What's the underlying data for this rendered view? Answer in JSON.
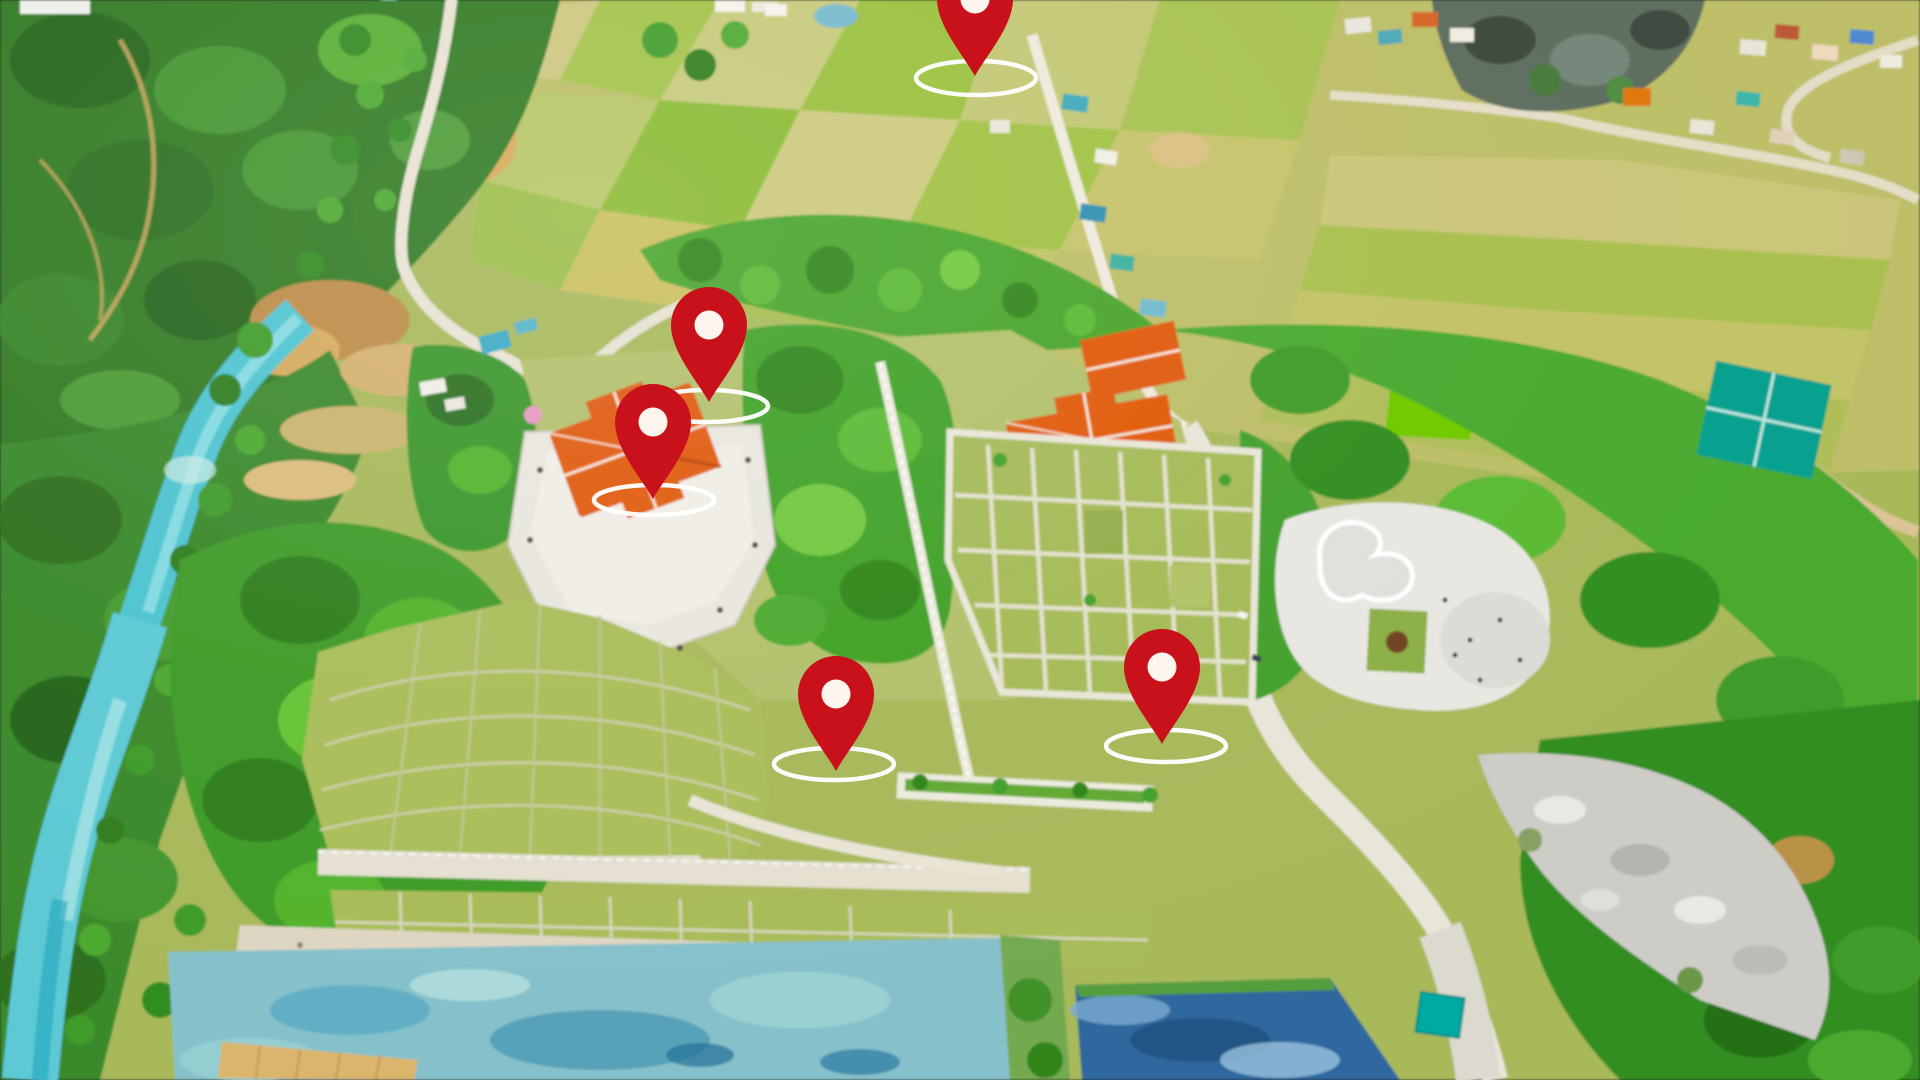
{
  "view": {
    "type": "aerial-drone-map-view",
    "width": 1920,
    "height": 1080,
    "visible_text": ""
  },
  "palette": {
    "pin_red": "#c8111a",
    "pin_hole": "#fdf6ef",
    "ring_white": "#ffffff",
    "river_turquoise": "#5fc2cd",
    "field_olive": "#bdbe74",
    "forest_green": "#3c7a31",
    "temple_roof_orange": "#d8602a",
    "terrace_white": "#e8e6df",
    "pond_milky_blue": "#8cc0c9",
    "pond_deep_blue": "#39689a",
    "road_light": "#e9e5da"
  },
  "marker_style": {
    "width": 76,
    "height": 115,
    "head_radius": 38,
    "hole_radius": 14.5,
    "ring_stroke_width": 4.5
  },
  "markers": [
    {
      "id": "marker-1",
      "tip_x": 975,
      "tip_y": 76,
      "ring": {
        "cx": 976,
        "cy": 78,
        "rx": 60,
        "ry": 17
      }
    },
    {
      "id": "marker-2",
      "tip_x": 709,
      "tip_y": 402,
      "ring": {
        "cx": 707,
        "cy": 406,
        "rx": 61,
        "ry": 16
      }
    },
    {
      "id": "marker-3",
      "tip_x": 653,
      "tip_y": 499,
      "ring": {
        "cx": 654,
        "cy": 500,
        "rx": 60,
        "ry": 15
      }
    },
    {
      "id": "marker-4",
      "tip_x": 836,
      "tip_y": 771,
      "ring": {
        "cx": 834,
        "cy": 764,
        "rx": 60,
        "ry": 16
      }
    },
    {
      "id": "marker-5",
      "tip_x": 1162,
      "tip_y": 744,
      "ring": {
        "cx": 1166,
        "cy": 746,
        "rx": 60,
        "ry": 16
      }
    }
  ]
}
